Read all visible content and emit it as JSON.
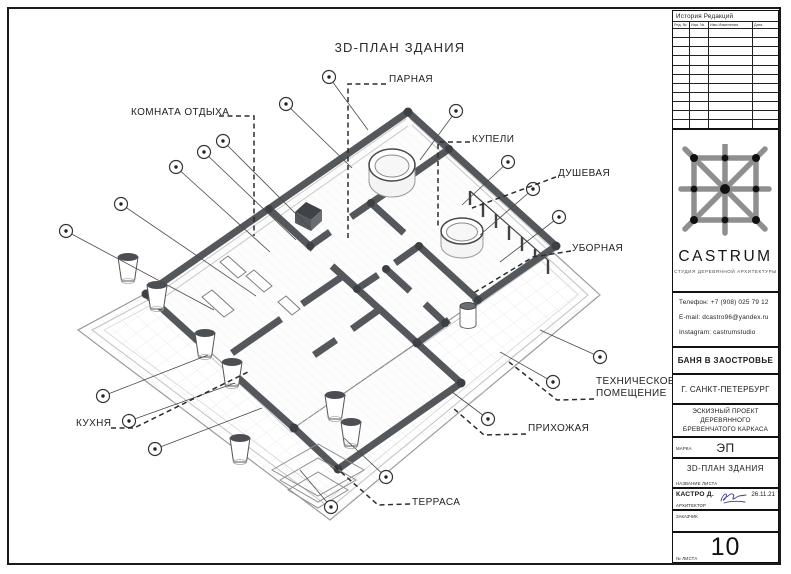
{
  "drawing": {
    "title": "3D-ПЛАН ЗДАНИЯ",
    "rooms": {
      "parnaya": "ПАРНАЯ",
      "komnata_otdyha": "КОМНАТА ОТДЫХА",
      "kupeli": "КУПЕЛИ",
      "dushevaya": "ДУШЕВАЯ",
      "ubornaya": "УБОРНАЯ",
      "tehnicheskoe": "ТЕХНИЧЕСКОЕ ПОМЕЩЕНИЕ",
      "prihozhaya": "ПРИХОЖАЯ",
      "kuhnya": "КУХНЯ",
      "terrasa": "ТЕРРАСА"
    }
  },
  "titleblock": {
    "revision_table": {
      "title": "История Редакций",
      "columns": [
        "Ред. №",
        "Изм. №",
        "Имя Изменения",
        "Дата"
      ],
      "empty_rows": 11
    },
    "logo": {
      "name": "CASTRUM",
      "subtitle": "СТУДИЯ ДЕРЕВЯННОЙ АРХИТЕКТУРЫ"
    },
    "contacts": {
      "phone": "Телефон: +7 (908) 025 79 12",
      "email": "E-mail: dcastro96@yandex.ru",
      "instagram": "Instagram: castrumstudio"
    },
    "project": "БАНЯ В ЗАОСТРОВЬЕ",
    "city": "Г. САНКТ-ПЕТЕРБУРГ",
    "project_type_line1": "ЭСКИЗНЫЙ ПРОЕКТ ДЕРЕВЯННОГО",
    "project_type_line2": "БРЕВЕНЧАТОГО КАРКАСА",
    "stage_label": "МАРКА",
    "stage_value": "ЭП",
    "sheet_name": "3D-ПЛАН ЗДАНИЯ",
    "sheet_name_label": "НАЗВАНИЕ ЛИСТА",
    "architect_label": "АРХИТЕКТОР",
    "architect_name": "КАСТРО Д.",
    "date": "26.11.21",
    "client_label": "ЗАКАЗЧИК",
    "sheet_number_label": "№ ЛИСТА",
    "sheet_number": "10"
  },
  "colors": {
    "wall": "#54585d",
    "line": "#444444",
    "accent_black": "#1a1a1a",
    "logo_gray": "#8f8f8f",
    "signature_ink": "#3a3f8c"
  }
}
